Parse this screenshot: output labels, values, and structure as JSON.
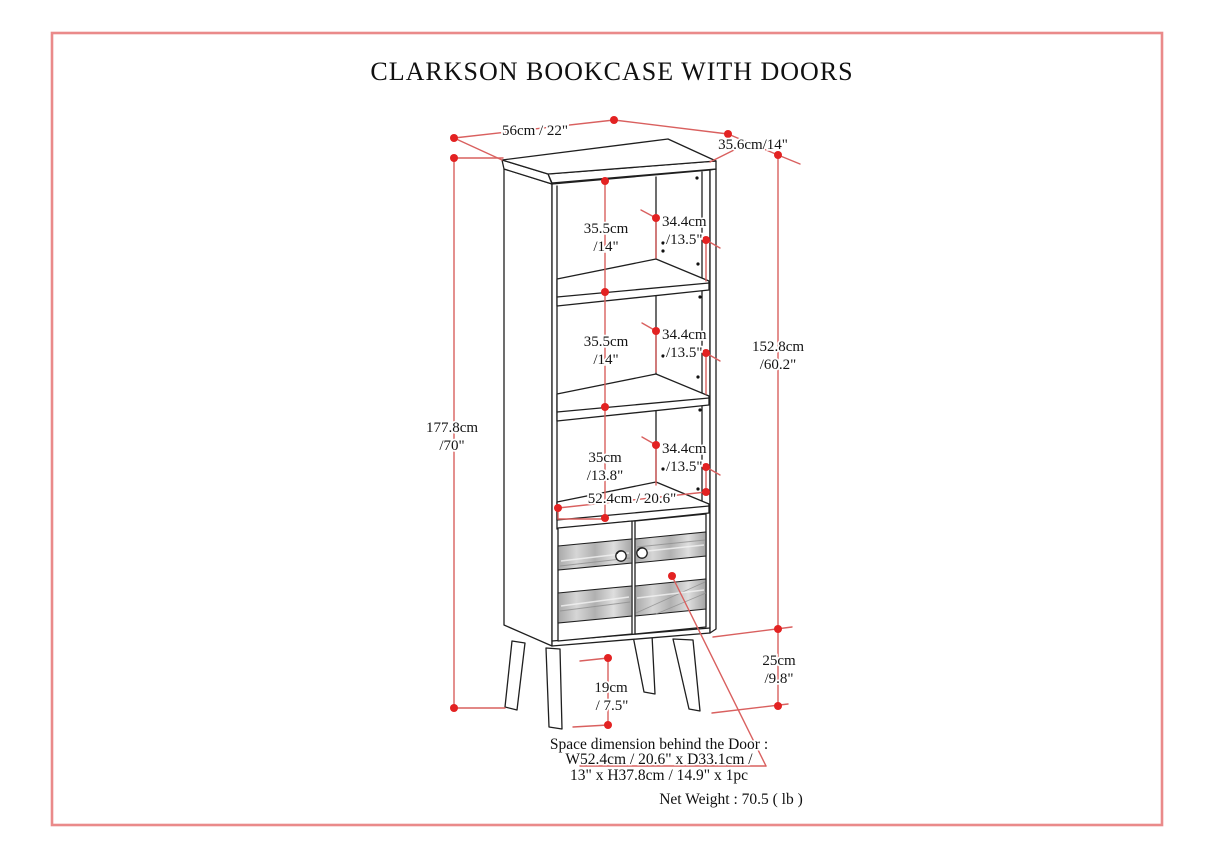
{
  "page": {
    "title": "CLARKSON BOOKCASE WITH DOORS",
    "border_color": "#ea8a8a",
    "dim_line_color": "#d9605f",
    "dim_dot_color": "#e32222"
  },
  "dimensions": {
    "top_width": "56cm / 22\"",
    "top_depth": "35.6cm/14\"",
    "overall_height": [
      "177.8cm",
      "/70\""
    ],
    "body_height": [
      "152.8cm",
      "/60.2\""
    ],
    "cubby1_height": [
      "35.5cm",
      "/14\""
    ],
    "cubby2_height": [
      "35.5cm",
      "/14\""
    ],
    "cubby3_height": [
      "35cm",
      "/13.8\""
    ],
    "cubby1_depth": [
      "34.4cm",
      "/13.5\""
    ],
    "cubby2_depth": [
      "34.4cm",
      "/13.5\""
    ],
    "cubby3_depth": [
      "34.4cm",
      "/13.5\""
    ],
    "interior_width": "52.4cm / 20.6\"",
    "leg_height": [
      "19cm",
      "/ 7.5\""
    ],
    "base_clearance": [
      "25cm",
      "/9.8\""
    ]
  },
  "notes": {
    "door_space_line1": "Space dimension behind the Door :",
    "door_space_line2": "W52.4cm / 20.6\" x D33.1cm /",
    "door_space_line3": "13\" x H37.8cm / 14.9\" x 1pc",
    "net_weight": "Net Weight : 70.5 ( lb )"
  }
}
